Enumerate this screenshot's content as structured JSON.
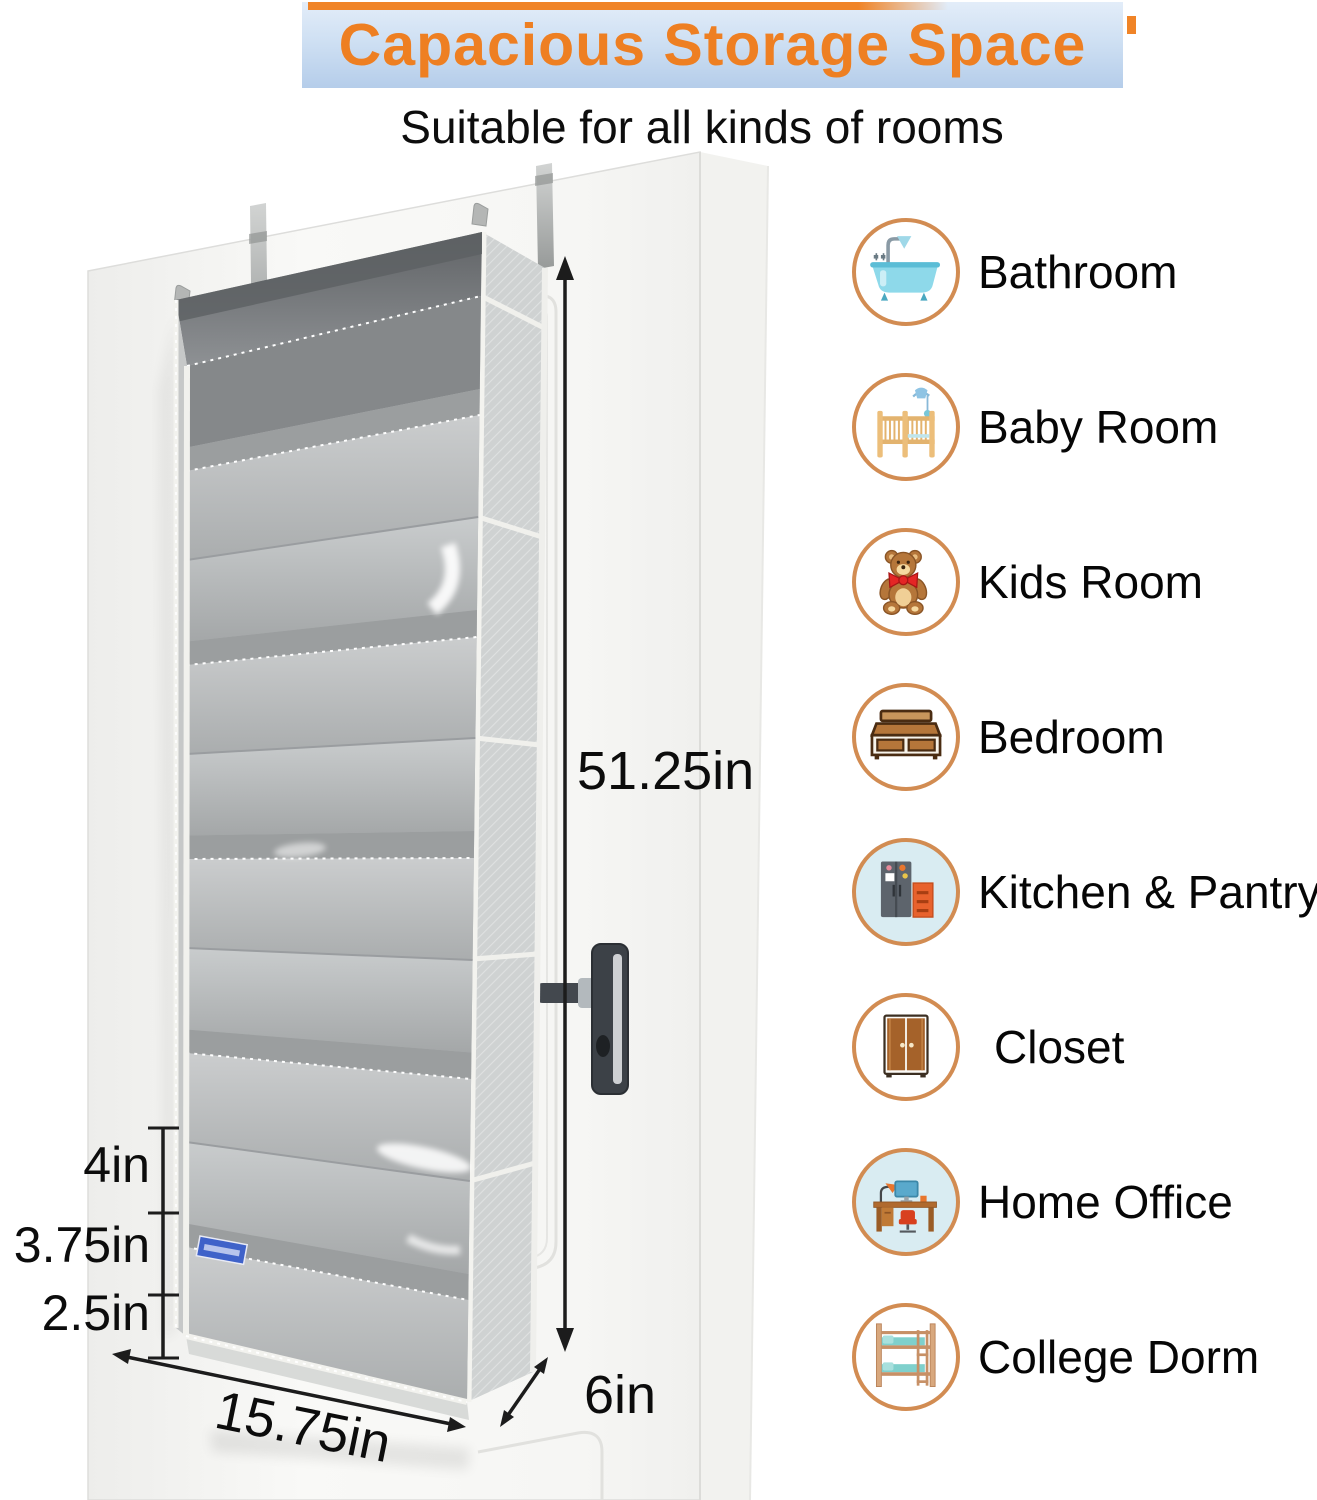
{
  "banner": {
    "title": "Capacious Storage Space",
    "title_color": "#ee7f22",
    "bg_top": "#e3edf9",
    "bg_bottom": "#b5cdea",
    "accent_color": "#f08427"
  },
  "subtitle": "Suitable for all kinds of rooms",
  "product": {
    "type": "over-door hanging organizer",
    "fabric_color": "#b6b9ba",
    "brand_tag_color": "#3f62c9",
    "pocket_count": 5
  },
  "dimensions": {
    "height": "51.25in",
    "width": "15.75in",
    "depth": "6in",
    "pocket_top": "4in",
    "pocket_middle": "3.75in",
    "pocket_bottom": "2.5in"
  },
  "rooms": [
    {
      "label": "Bathroom",
      "icon": "bathtub-icon"
    },
    {
      "label": "Baby Room",
      "icon": "crib-icon"
    },
    {
      "label": "Kids Room",
      "icon": "teddy-bear-icon"
    },
    {
      "label": "Bedroom",
      "icon": "bed-icon"
    },
    {
      "label": "Kitchen & Pantry",
      "icon": "refrigerator-icon"
    },
    {
      "label": "Closet",
      "icon": "wardrobe-icon"
    },
    {
      "label": "Home Office",
      "icon": "desk-icon"
    },
    {
      "label": "College Dorm",
      "icon": "bunk-bed-icon"
    }
  ],
  "legend": {
    "ring_color": "#d28c52",
    "label_color": "#060606"
  }
}
